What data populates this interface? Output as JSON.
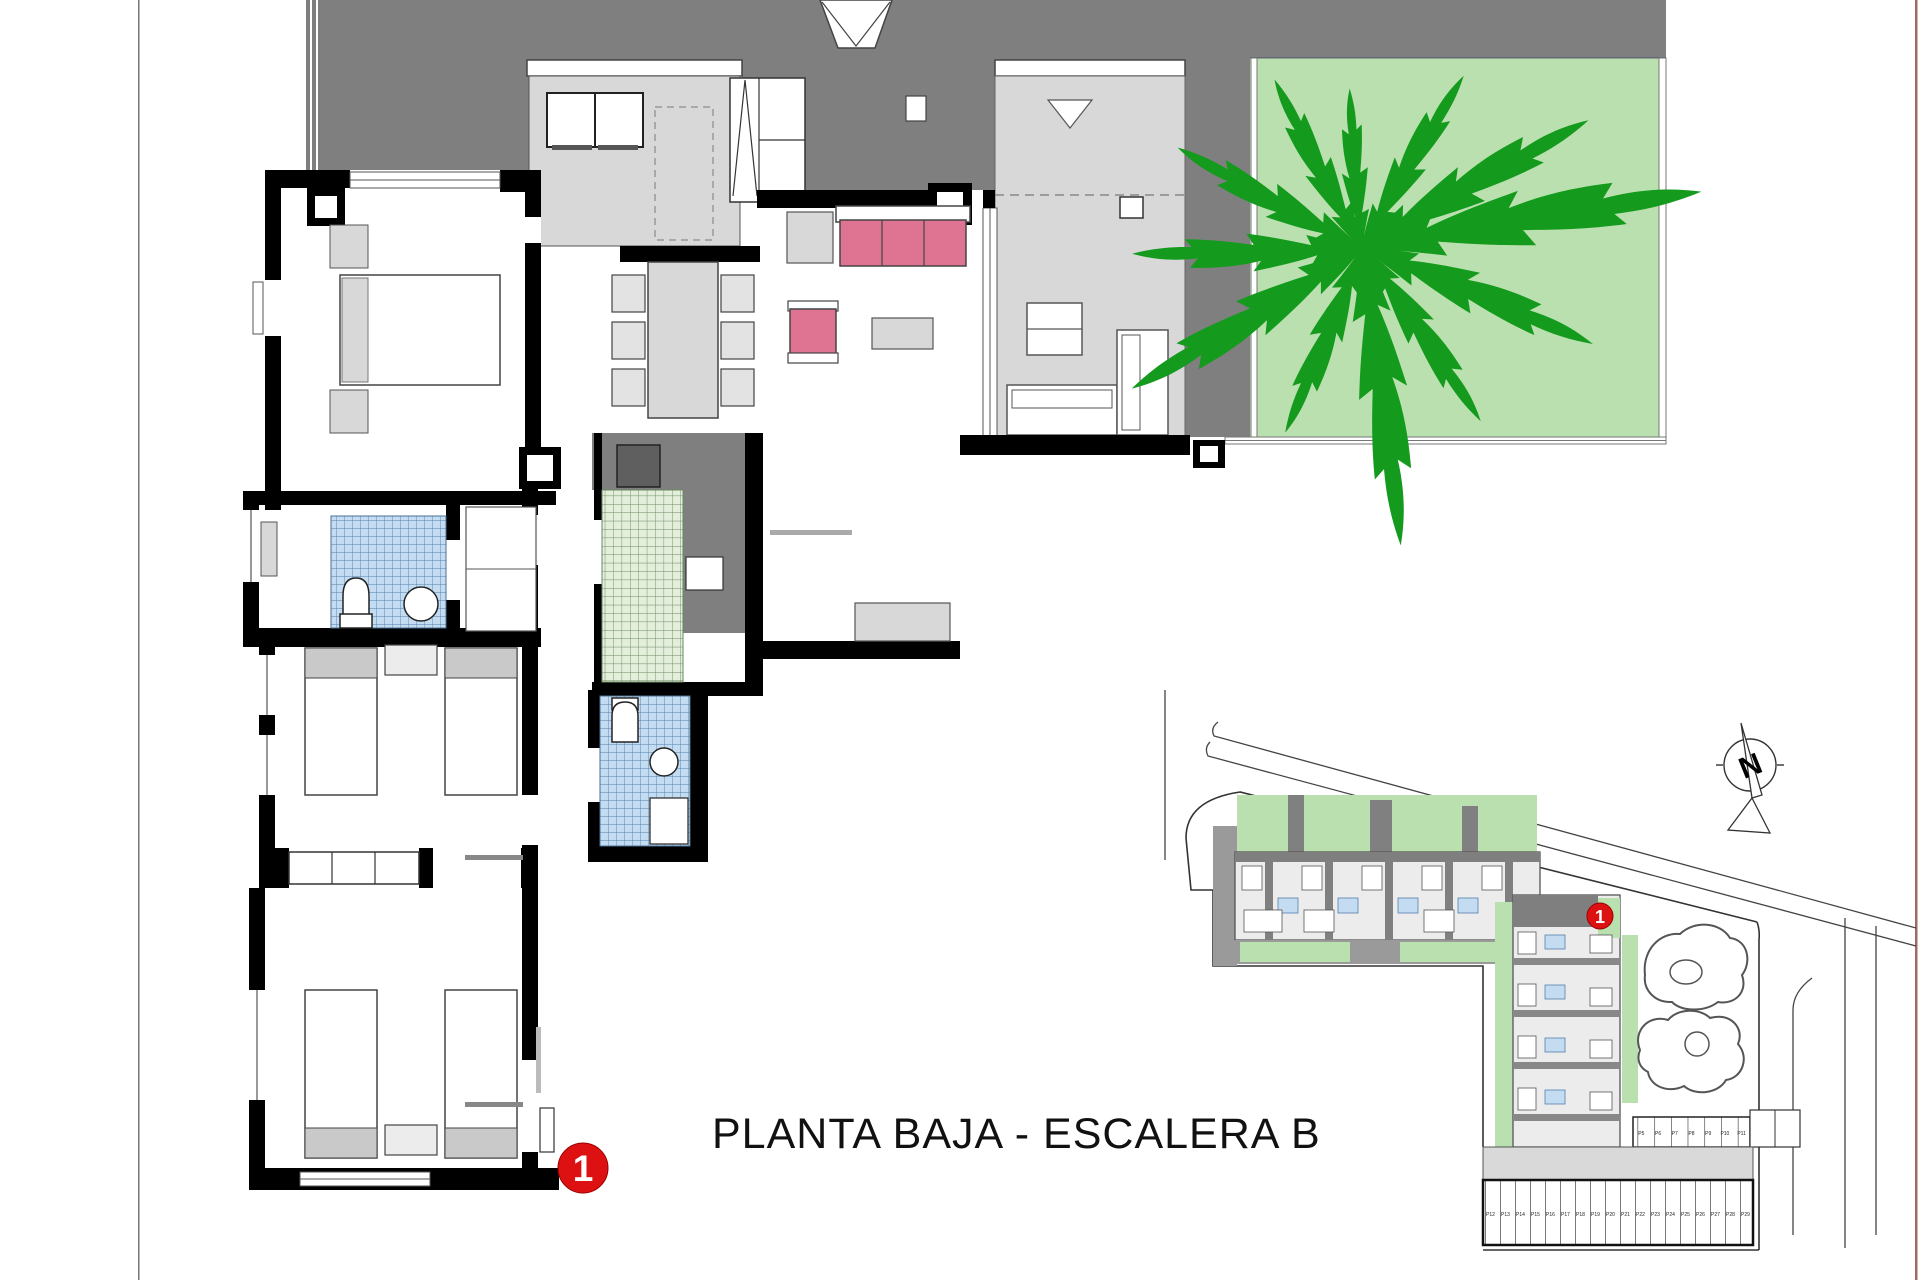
{
  "document": {
    "title_label": "PLANTA BAJA - ESCALERA B"
  },
  "markers": {
    "floorplan_unit": "1",
    "siteplan_unit": "1"
  },
  "north_arrow": {
    "label": "N"
  },
  "site_plan": {
    "parking_row_bottom": [
      "P12",
      "P13",
      "P14",
      "P15",
      "P16",
      "P17",
      "P18",
      "P19",
      "P20",
      "P21",
      "P22",
      "P23",
      "P24",
      "P25",
      "P26",
      "P27",
      "P28",
      "P29"
    ],
    "parking_row_upper": [
      "P5",
      "P6",
      "P7",
      "P8",
      "P9",
      "P10",
      "P11"
    ]
  },
  "palette": {
    "terrace_dark_gray": "#7f7f7f",
    "covered_area_gray": "#d8d8d8",
    "garden_green": "#b9e0ae",
    "tree_green": "#149a1d",
    "sofa_pink": "#df7392",
    "tile_blue": "#c3dcf2",
    "tile_green": "#e3eedb",
    "wall_black": "#000000",
    "marker_red": "#dd1111",
    "page_border_right": "#9b6b66"
  }
}
